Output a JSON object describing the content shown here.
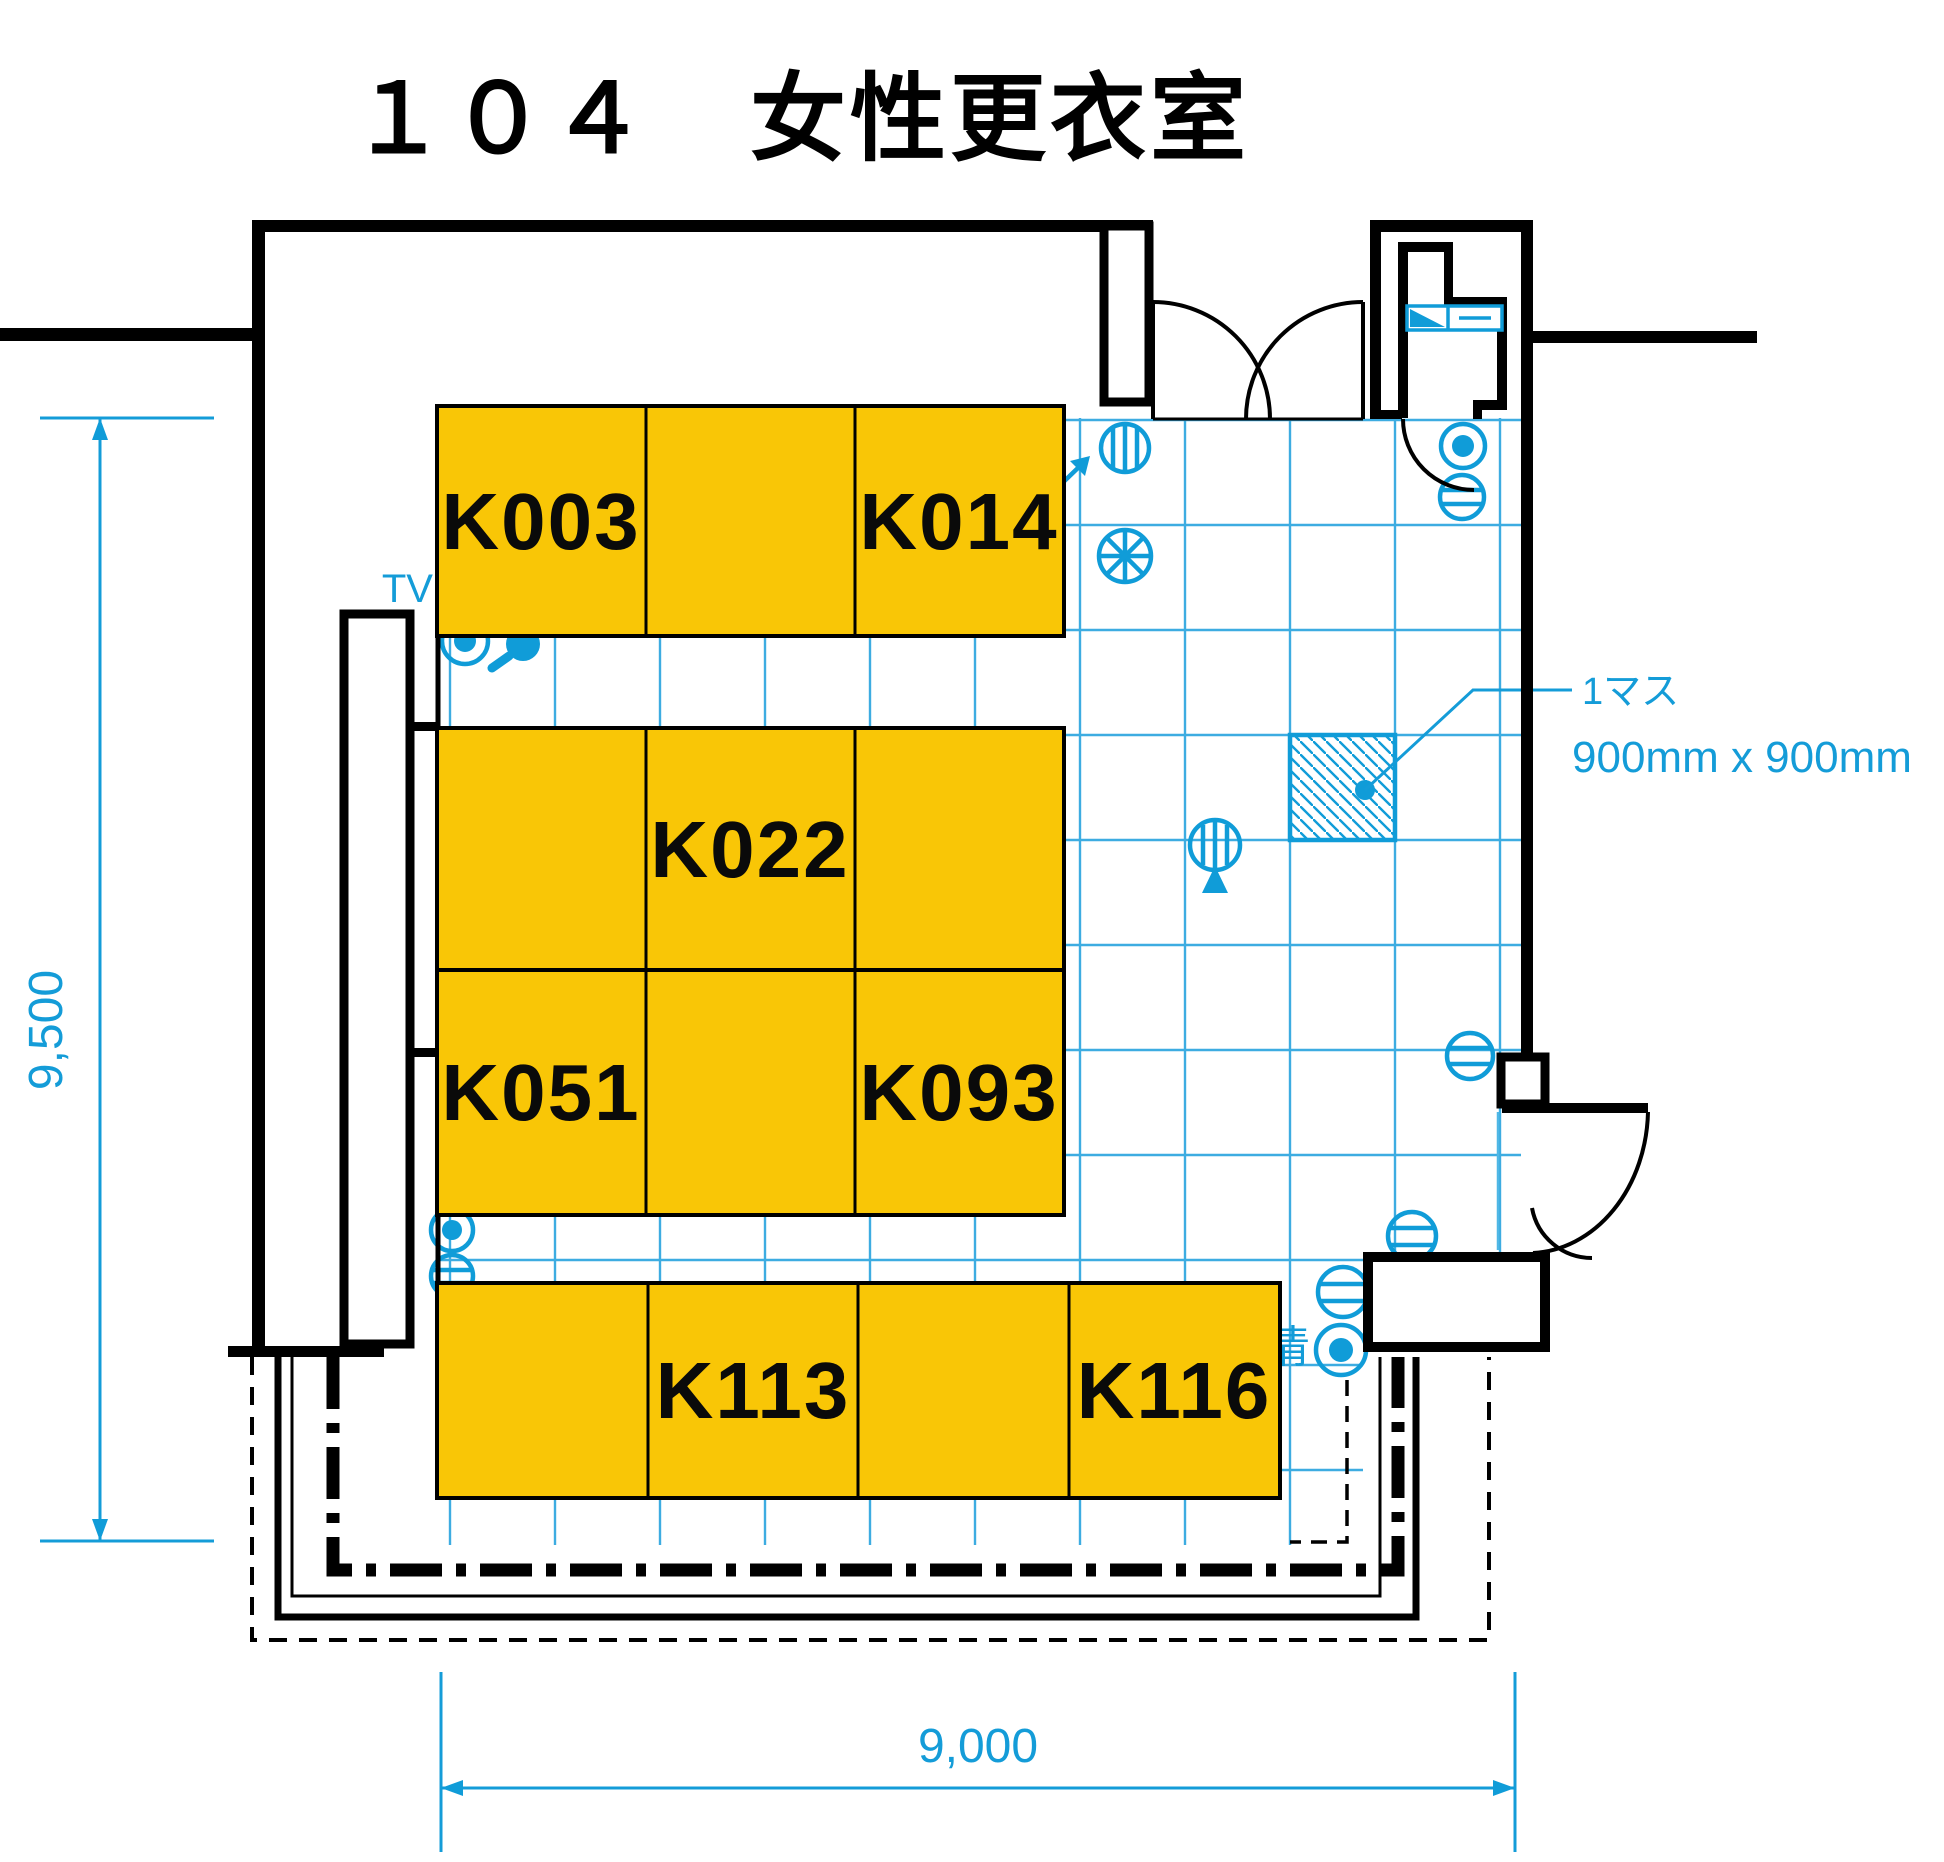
{
  "title": "１０４　女性更衣室",
  "room": {
    "number": "１０４",
    "name": "女性更衣室"
  },
  "lockers": {
    "b1": "K003",
    "b2": "K014",
    "b3": "K022",
    "b4": "K051",
    "b5": "K093",
    "b6": "K113",
    "b7": "K116"
  },
  "labels": {
    "tv": "TV",
    "partial_kanji": "清"
  },
  "grid_note": {
    "line1": "1マス",
    "line2": "900mm x 900mm",
    "cell_size_mm": 900
  },
  "dimensions": {
    "width": "9,000",
    "height": "9,500",
    "unit": "mm"
  },
  "colors": {
    "locker_fill": "#f9c606",
    "fixture_blue": "#109cd8",
    "grid_blue": "#3dace1",
    "wall_black": "#000000"
  },
  "fixtures": [
    "supply-diffuser",
    "ceiling-fan",
    "direction-arrow",
    "downlight",
    "sensor",
    "exhaust-grille",
    "thermostat",
    "wall-panel",
    "hatched-grid-cell"
  ]
}
